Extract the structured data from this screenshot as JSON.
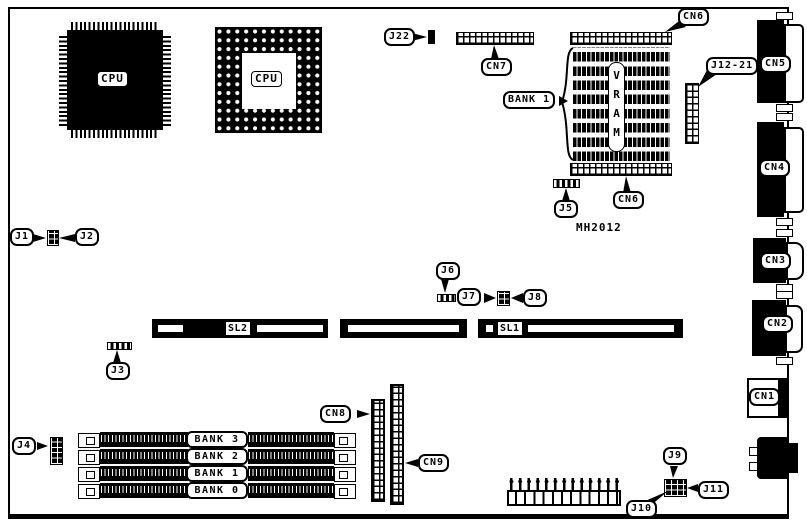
{
  "board": {
    "cpus": {
      "qfp_label": "CPU",
      "pga_label": "CPU"
    },
    "memory": {
      "vram_label": "VRAM",
      "vram_bank_label": "BANK 1",
      "chip_part": "MH2012",
      "simm_banks": [
        "BANK 3",
        "BANK 2",
        "BANK 1",
        "BANK 0"
      ]
    },
    "slots": {
      "sl1": "SL1",
      "sl2": "SL2"
    },
    "connectors": {
      "cn1": "CN1",
      "cn2": "CN2",
      "cn3": "CN3",
      "cn4": "CN4",
      "cn5": "CN5",
      "cn6_top": "CN6",
      "cn6_bottom": "CN6",
      "cn7": "CN7",
      "cn8": "CN8",
      "cn9": "CN9"
    },
    "jumpers": {
      "j1": "J1",
      "j2": "J2",
      "j3": "J3",
      "j4": "J4",
      "j5": "J5",
      "j6": "J6",
      "j7": "J7",
      "j8": "J8",
      "j9": "J9",
      "j10": "J10",
      "j11": "J11",
      "j12_21": "J12-21",
      "j22": "J22"
    },
    "colors": {
      "ink": "#000000",
      "paper": "#ffffff"
    }
  }
}
